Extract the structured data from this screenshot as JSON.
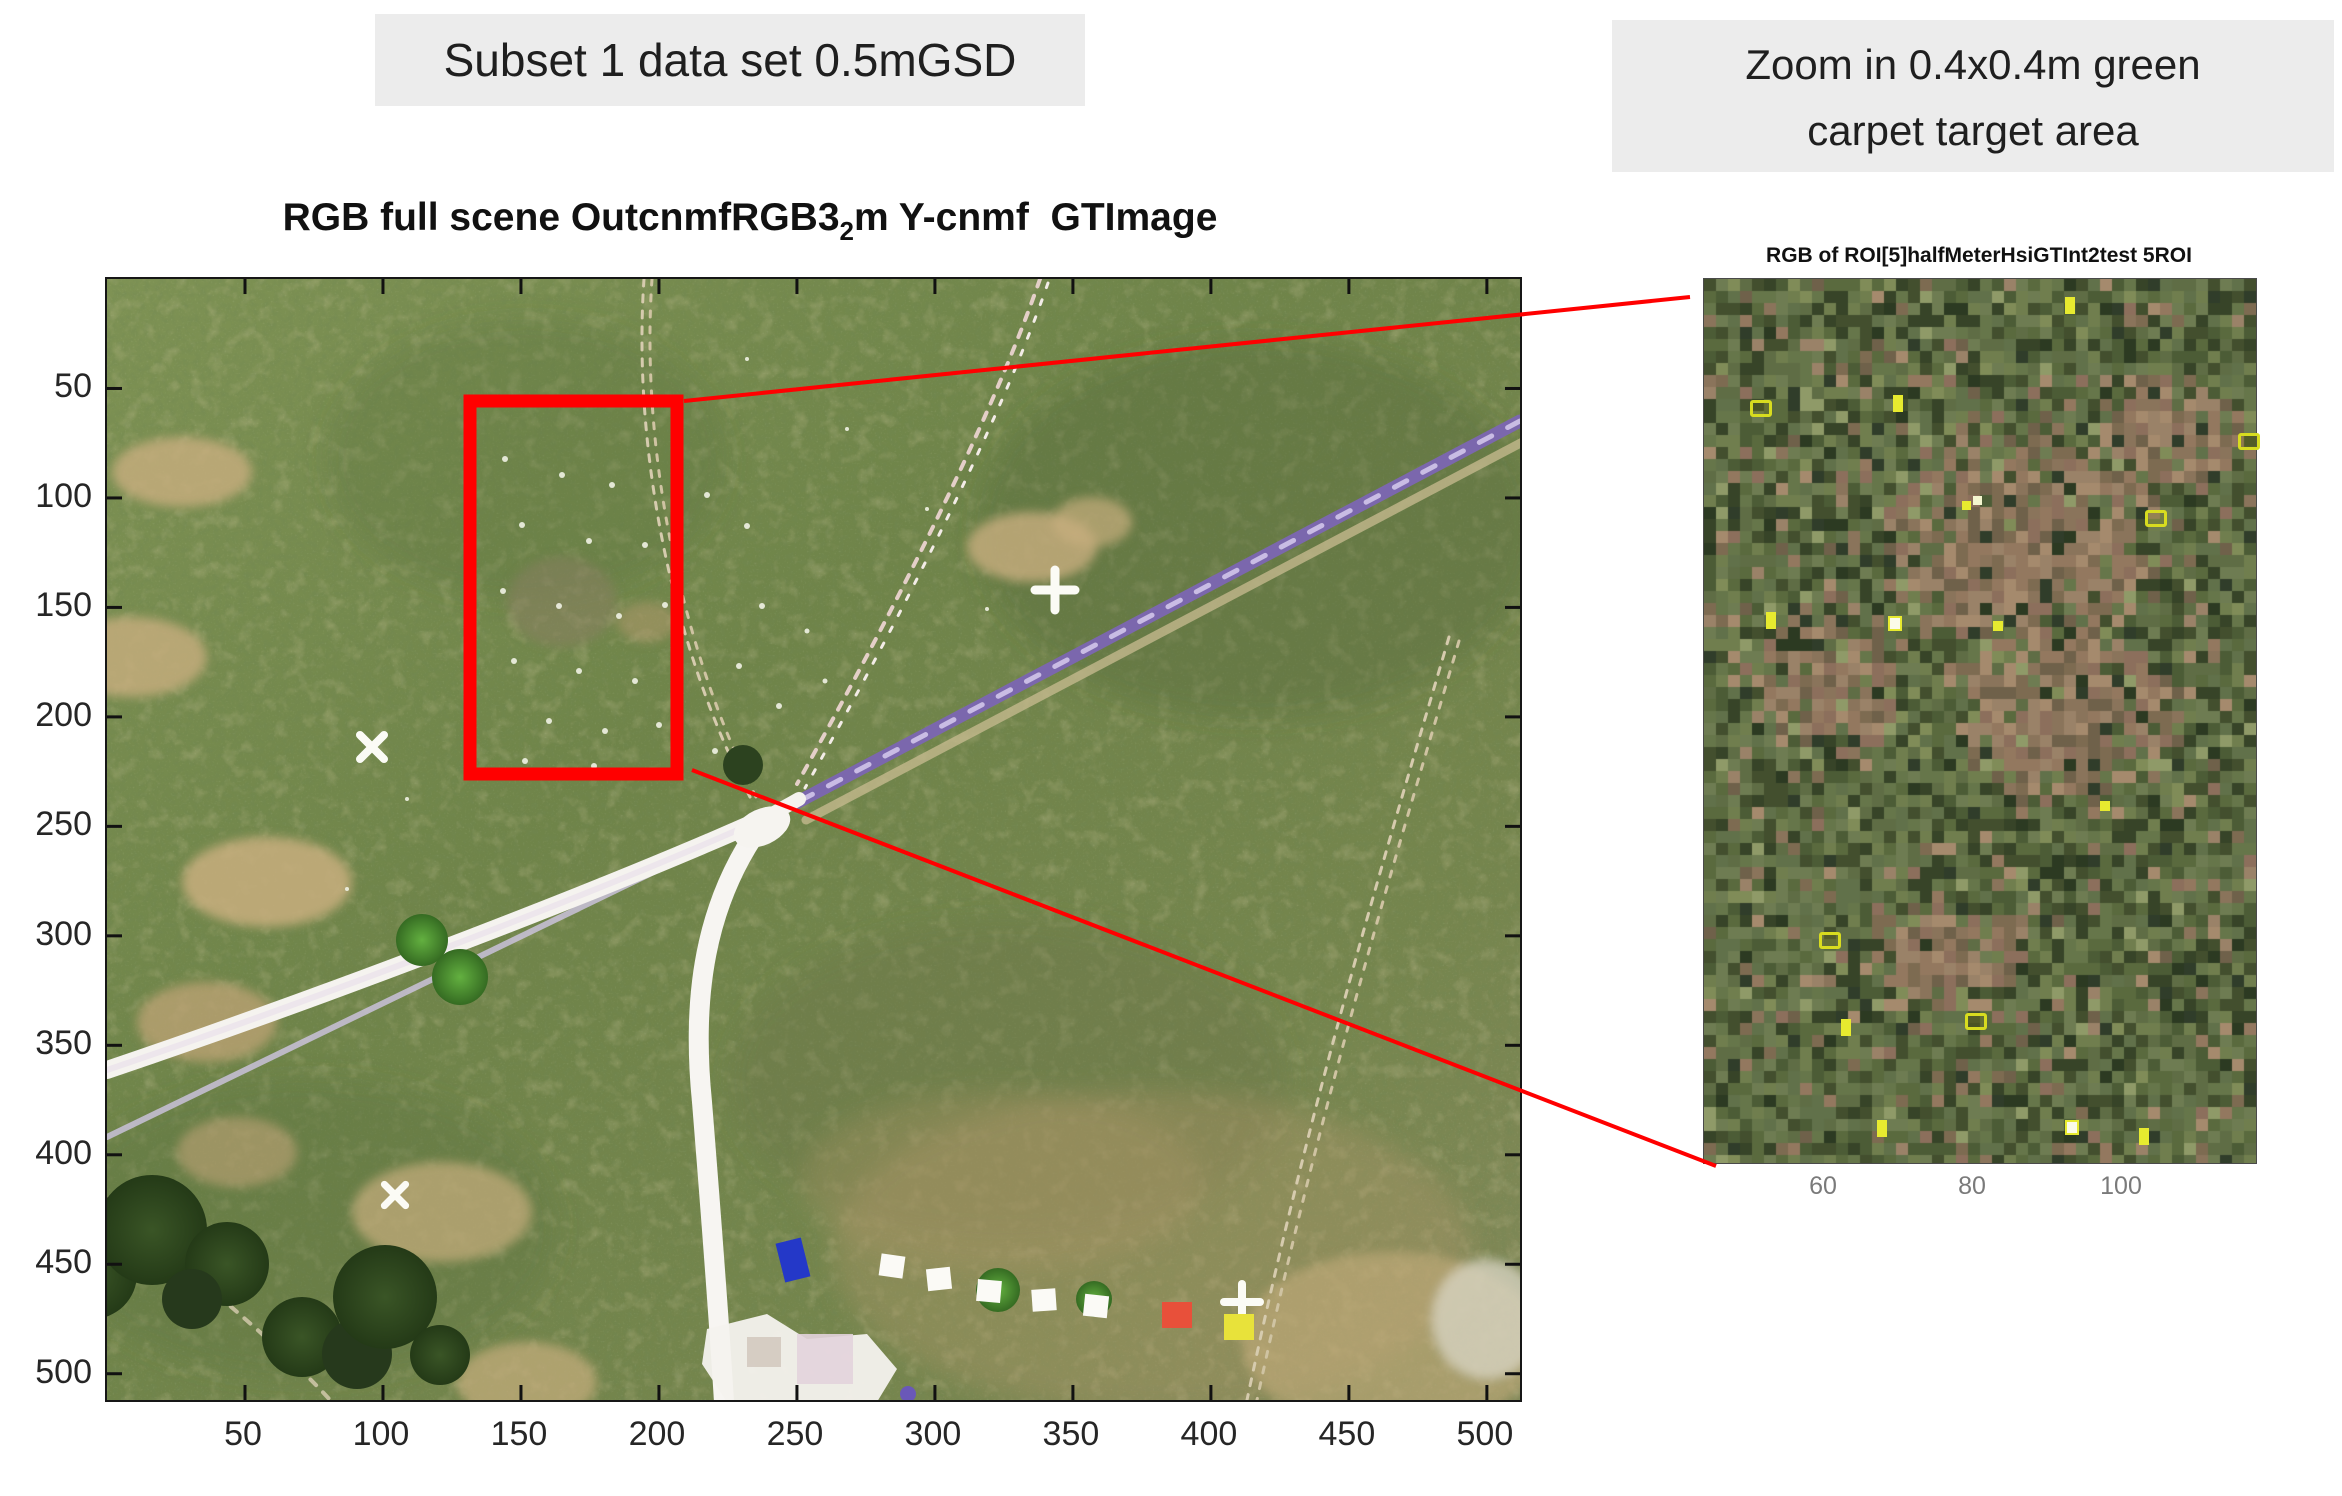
{
  "header": {
    "subset_label": "Subset 1 data set 0.5mGSD",
    "zoom_label_line1": "Zoom in 0.4x0.4m green",
    "zoom_label_line2": "carpet target area",
    "label_bg": "#ececec"
  },
  "main_plot": {
    "title_prefix": "RGB full scene OutcnmfRGB3",
    "title_subscript": "2",
    "title_suffix": "m Y-cnmf  GTImage",
    "x_ticks": [
      50,
      100,
      150,
      200,
      250,
      300,
      350,
      400,
      450,
      500
    ],
    "y_ticks": [
      50,
      100,
      150,
      200,
      250,
      300,
      350,
      400,
      450,
      500
    ]
  },
  "roi_plot": {
    "title": "RGB of ROI[5]halfMeterHsiGTInt2test 5ROI",
    "x_ticks": [
      60,
      80,
      100
    ],
    "markers": [
      {
        "x": 65.5,
        "y": 2.2,
        "kind": "bar"
      },
      {
        "x": 8.5,
        "y": 13.8,
        "kind": "ring"
      },
      {
        "x": 34.5,
        "y": 13.2,
        "kind": "bar"
      },
      {
        "x": 47.0,
        "y": 25.2,
        "kind": "dot2"
      },
      {
        "x": 80.0,
        "y": 26.2,
        "kind": "ring"
      },
      {
        "x": 97.0,
        "y": 17.5,
        "kind": "ring"
      },
      {
        "x": 11.5,
        "y": 37.8,
        "kind": "bar"
      },
      {
        "x": 33.5,
        "y": 38.2,
        "kind": "bright"
      },
      {
        "x": 52.5,
        "y": 38.8,
        "kind": "dot"
      },
      {
        "x": 72.0,
        "y": 59.2,
        "kind": "dot"
      },
      {
        "x": 21.0,
        "y": 74.0,
        "kind": "ring"
      },
      {
        "x": 25.0,
        "y": 83.8,
        "kind": "bar"
      },
      {
        "x": 47.5,
        "y": 83.2,
        "kind": "ring"
      },
      {
        "x": 31.5,
        "y": 95.2,
        "kind": "bar"
      },
      {
        "x": 65.5,
        "y": 95.2,
        "kind": "bright"
      },
      {
        "x": 79.0,
        "y": 96.2,
        "kind": "bar"
      }
    ]
  },
  "annotation": {
    "rect_color": "#ff0000",
    "line_color": "#ff0000"
  },
  "colors": {
    "target_marker_yellow": "#e7ea2f",
    "road_purple": "#7b67ad",
    "grass_green": "#6f8449",
    "path_white": "#f5f3ef",
    "tick_label": "#262626",
    "roi_tick_label": "#7a7a7a"
  },
  "chart_data": [
    {
      "type": "image",
      "title": "RGB full scene OutcnmfRGB3_2m Y-cnmf GTImage",
      "xlabel": "",
      "ylabel": "",
      "x_ticks": [
        50,
        100,
        150,
        200,
        250,
        300,
        350,
        400,
        450,
        500
      ],
      "y_ticks": [
        50,
        100,
        150,
        200,
        250,
        300,
        350,
        400,
        450,
        500
      ],
      "x_range": [
        0,
        512
      ],
      "y_range": [
        0,
        512
      ],
      "grid": false,
      "content": "0.5 m GSD aerial RGB orthophoto of grassland: purple footpath running diagonally from upper right to a white trail junction in the center, white paths forking to lower-left and bottom, dotted field trails, tree clusters in the lower left, tan dry-grass patches, small white X / + ground markers and rows of white calibration squares plus one orange and one yellow panel near the bottom",
      "annotations": [
        {
          "type": "roi-rectangle",
          "x_range": [
            131,
            207
          ],
          "y_range": [
            56,
            226
          ],
          "color": "#ff0000",
          "meaning": "green carpet target area"
        }
      ]
    },
    {
      "type": "image",
      "title": "RGB of ROI[5]halfMeterHsiGTInt2test 5ROI",
      "xlabel": "",
      "ylabel": "",
      "x_ticks": [
        60,
        80,
        100
      ],
      "grid": false,
      "content": "pixelated zoom of the 0.4x0.4m green carpet target area; mottled green/brown mosaic with 16 small bright-yellow target markers",
      "marker_positions_percent": [
        [
          65.5,
          2.2
        ],
        [
          8.5,
          13.8
        ],
        [
          34.5,
          13.2
        ],
        [
          47.0,
          25.2
        ],
        [
          80.0,
          26.2
        ],
        [
          97.0,
          17.5
        ],
        [
          11.5,
          37.8
        ],
        [
          33.5,
          38.2
        ],
        [
          52.5,
          38.8
        ],
        [
          72.0,
          59.2
        ],
        [
          21.0,
          74.0
        ],
        [
          25.0,
          83.8
        ],
        [
          47.5,
          83.2
        ],
        [
          31.5,
          95.2
        ],
        [
          65.5,
          95.2
        ],
        [
          79.0,
          96.2
        ]
      ]
    }
  ]
}
